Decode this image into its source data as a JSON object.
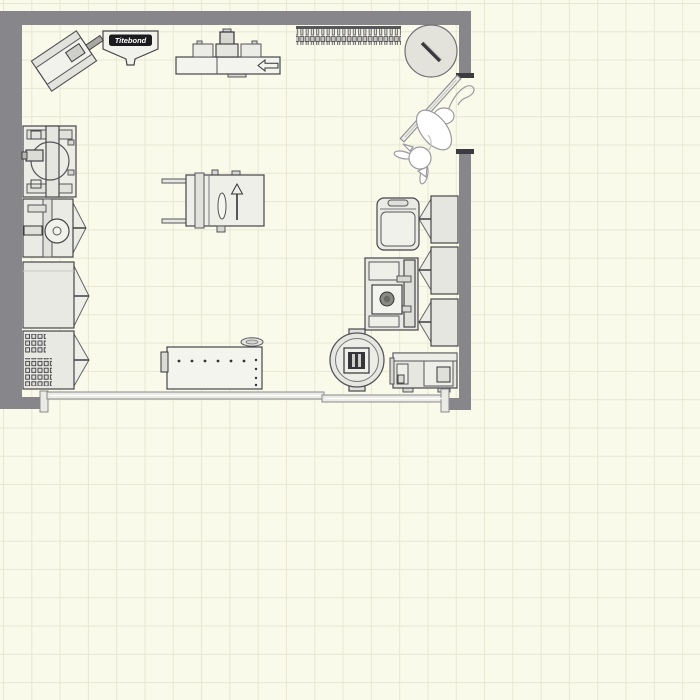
{
  "floorplan": {
    "glue_bottle_label": "Titebond",
    "colors": {
      "background": "#fafaea",
      "grid_line": "#e7e7d4",
      "wall": "#87878b",
      "wall_dark_tick": "#3c3c40",
      "object_fill": "#efefe9",
      "object_fill_dark": "#dededa",
      "object_outline": "#45454a",
      "label_bg": "#1b1b1f",
      "label_text": "#ffffff"
    },
    "items": [
      {
        "name": "benchtop-tool-angled"
      },
      {
        "name": "glue-bottle",
        "label": "Titebond"
      },
      {
        "name": "radial-arm-saw"
      },
      {
        "name": "clamp-rack"
      },
      {
        "name": "round-stool"
      },
      {
        "name": "door"
      },
      {
        "name": "cat"
      },
      {
        "name": "lathe"
      },
      {
        "name": "band-saw"
      },
      {
        "name": "storage-cabinet"
      },
      {
        "name": "pegboard-cabinet"
      },
      {
        "name": "table-saw"
      },
      {
        "name": "wall-cabinet-1"
      },
      {
        "name": "wall-cabinet-2"
      },
      {
        "name": "wall-cabinet-3"
      },
      {
        "name": "rolling-cart"
      },
      {
        "name": "drill-press"
      },
      {
        "name": "wood-stove"
      },
      {
        "name": "planer"
      },
      {
        "name": "workbench"
      },
      {
        "name": "lumber-rack"
      }
    ]
  }
}
